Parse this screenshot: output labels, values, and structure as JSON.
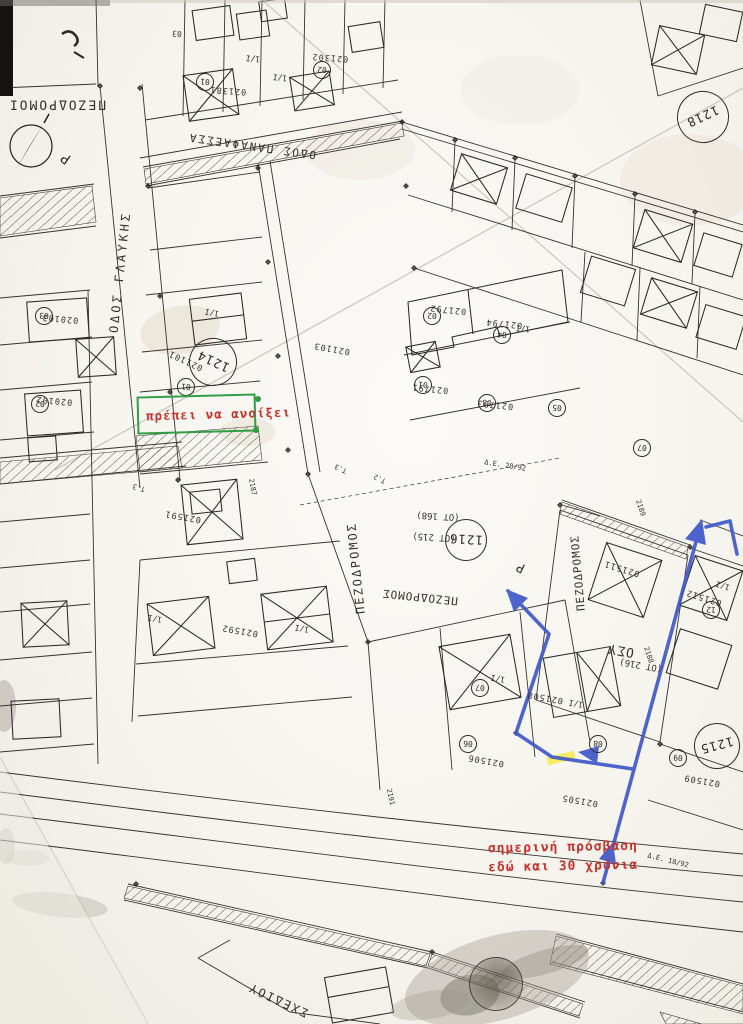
{
  "annotations": {
    "green_note": {
      "text": "πρέπει να ανοίξει"
    },
    "access_note": {
      "line1": "σημερινή πρόσβαση",
      "line2": "εδώ και 30 χρόνια"
    }
  },
  "colors": {
    "annotation_red": "#c8322b",
    "annotation_green": "#2f9e44",
    "annotation_blue": "#3f57c9",
    "highlight_yellow": "#f4ea3e",
    "ink": "#35332f"
  },
  "block_circles": [
    {
      "v": "1214",
      "x": 213,
      "y": 362,
      "rad": 24,
      "r": 205
    },
    {
      "v": "1216",
      "x": 466,
      "y": 540,
      "rad": 21,
      "r": 183
    },
    {
      "v": "1218",
      "x": 703,
      "y": 117,
      "rad": 26,
      "r": 155
    },
    {
      "v": "1215",
      "x": 717,
      "y": 746,
      "rad": 23,
      "r": 165
    },
    {
      "v": "",
      "x": 496,
      "y": 984,
      "rad": 27,
      "r": 160,
      "smudged": true
    }
  ],
  "lot_circles": [
    {
      "v": "01",
      "x": 205,
      "y": 82
    },
    {
      "v": "02",
      "x": 322,
      "y": 70
    },
    {
      "v": "01",
      "x": 186,
      "y": 387
    },
    {
      "v": "03",
      "x": 44,
      "y": 316
    },
    {
      "v": "02",
      "x": 40,
      "y": 404
    },
    {
      "v": "01",
      "x": 423,
      "y": 385
    },
    {
      "v": "02",
      "x": 432,
      "y": 316
    },
    {
      "v": "03",
      "x": 487,
      "y": 403
    },
    {
      "v": "04",
      "x": 502,
      "y": 335
    },
    {
      "v": "05",
      "x": 557,
      "y": 408
    },
    {
      "v": "07",
      "x": 642,
      "y": 448
    },
    {
      "v": "12",
      "x": 711,
      "y": 610
    },
    {
      "v": "08",
      "x": 598,
      "y": 744
    },
    {
      "v": "09",
      "x": 678,
      "y": 758
    },
    {
      "v": "06",
      "x": 468,
      "y": 744
    },
    {
      "v": "07",
      "x": 480,
      "y": 688
    }
  ],
  "map_labels": [
    {
      "t": "ΠΕΖΟΔΡΟΜΟΙ",
      "x": 57,
      "y": 104,
      "r": 180,
      "s": 13,
      "sp": 2,
      "n": "street-label-pezodromoi"
    },
    {
      "t": "Ρ",
      "x": 66,
      "y": 158,
      "r": 215,
      "s": 14,
      "n": "letter-p-mark"
    },
    {
      "t": "ΟΔΟΣ ΓΛΑΥΚΗΣ",
      "x": 120,
      "y": 272,
      "r": -84,
      "s": 12,
      "sp": 3,
      "n": "street-label-odos-glafkis"
    },
    {
      "t": "ΟΔΟΣ ΠΑΝΑΦΑΕΣΣΑ",
      "x": 252,
      "y": 146,
      "r": 188,
      "s": 11,
      "sp": 2,
      "n": "street-label-odos-panafaessa"
    },
    {
      "t": "ΠΕΖΟΔΡΟΜΟΣ",
      "x": 356,
      "y": 568,
      "r": -96,
      "s": 12,
      "sp": 2,
      "n": "street-label-pezodromos-center"
    },
    {
      "t": "ΠΕΖΟΔΡΟΜΟΣ",
      "x": 420,
      "y": 597,
      "r": 186,
      "s": 11,
      "sp": 1,
      "n": "street-label-pezodromos-south"
    },
    {
      "t": "ΠΕΖΟΔΡΟΜΟΣ",
      "x": 578,
      "y": 573,
      "r": -95,
      "s": 11,
      "sp": 1,
      "n": "street-label-pezodromos-east"
    },
    {
      "t": "Ρ",
      "x": 521,
      "y": 567,
      "r": 205,
      "s": 13,
      "n": "letter-p-mark-2"
    },
    {
      "t": "ΣΧΕΔΙΟΥ",
      "x": 278,
      "y": 1000,
      "r": 205,
      "s": 12,
      "sp": 2,
      "n": "label-schediou"
    },
    {
      "t": "ΟΣΥ",
      "x": 621,
      "y": 650,
      "r": 190,
      "s": 13,
      "sp": 1,
      "n": "label-osy"
    },
    {
      "t": "(ΟΤ 216)",
      "x": 641,
      "y": 664,
      "r": 190,
      "s": 9,
      "n": "block-ref-ot216"
    },
    {
      "t": "(ΟΤ 168)",
      "x": 438,
      "y": 515,
      "r": 183,
      "s": 9,
      "n": "block-ref-ot168"
    },
    {
      "t": "(ΟΤ 215)",
      "x": 434,
      "y": 536,
      "r": 183,
      "s": 9,
      "n": "block-ref-ot215"
    },
    {
      "t": "021381",
      "x": 228,
      "y": 90,
      "r": 184,
      "s": 8.5,
      "sp": 1,
      "n": "parcel-number"
    },
    {
      "t": "021302",
      "x": 330,
      "y": 57,
      "r": 184,
      "s": 8.5,
      "sp": 1,
      "n": "parcel-number"
    },
    {
      "t": "021101",
      "x": 186,
      "y": 360,
      "r": 205,
      "s": 8.5,
      "sp": 1,
      "n": "parcel-number"
    },
    {
      "t": "020103",
      "x": 60,
      "y": 318,
      "r": 185,
      "s": 8.5,
      "sp": 1,
      "n": "parcel-number"
    },
    {
      "t": "020102",
      "x": 54,
      "y": 400,
      "r": 185,
      "s": 8.5,
      "sp": 1,
      "n": "parcel-number"
    },
    {
      "t": "021103",
      "x": 332,
      "y": 348,
      "r": 190,
      "s": 8.5,
      "sp": 1,
      "n": "parcel-number"
    },
    {
      "t": "021591",
      "x": 183,
      "y": 516,
      "r": 190,
      "s": 8.5,
      "sp": 1,
      "n": "parcel-number"
    },
    {
      "t": "021592",
      "x": 240,
      "y": 630,
      "r": 190,
      "s": 8.5,
      "sp": 1,
      "n": "parcel-number"
    },
    {
      "t": "021792",
      "x": 448,
      "y": 309,
      "r": 186,
      "s": 8.5,
      "sp": 1,
      "n": "parcel-number"
    },
    {
      "t": "021794",
      "x": 504,
      "y": 323,
      "r": 186,
      "s": 8.5,
      "sp": 1,
      "n": "parcel-number"
    },
    {
      "t": "021791",
      "x": 430,
      "y": 388,
      "r": 186,
      "s": 8.5,
      "sp": 1,
      "n": "parcel-number"
    },
    {
      "t": "021793",
      "x": 495,
      "y": 404,
      "r": 186,
      "s": 8.5,
      "sp": 1,
      "n": "parcel-number"
    },
    {
      "t": "021511",
      "x": 622,
      "y": 568,
      "r": 197,
      "s": 8.5,
      "sp": 1,
      "n": "parcel-number"
    },
    {
      "t": "021512",
      "x": 704,
      "y": 597,
      "r": 197,
      "s": 8.5,
      "sp": 1,
      "n": "parcel-number"
    },
    {
      "t": "021508",
      "x": 545,
      "y": 697,
      "r": 190,
      "s": 8.5,
      "sp": 1,
      "n": "parcel-number"
    },
    {
      "t": "021506",
      "x": 486,
      "y": 760,
      "r": 190,
      "s": 8.5,
      "sp": 1,
      "n": "parcel-number"
    },
    {
      "t": "021505",
      "x": 580,
      "y": 800,
      "r": 190,
      "s": 8.5,
      "sp": 1,
      "n": "parcel-number"
    },
    {
      "t": "021509",
      "x": 702,
      "y": 780,
      "r": 190,
      "s": 8.5,
      "sp": 1,
      "n": "parcel-number"
    },
    {
      "t": "1/Ι",
      "x": 253,
      "y": 58,
      "r": 186,
      "s": 8,
      "n": "floor-label"
    },
    {
      "t": "1/Ι",
      "x": 280,
      "y": 77,
      "r": 186,
      "s": 8,
      "n": "floor-label"
    },
    {
      "t": "1/Ι",
      "x": 212,
      "y": 312,
      "r": 190,
      "s": 8,
      "n": "floor-label"
    },
    {
      "t": "1/Ι",
      "x": 523,
      "y": 328,
      "r": 186,
      "s": 8,
      "n": "floor-label"
    },
    {
      "t": "1/Ι",
      "x": 498,
      "y": 678,
      "r": 190,
      "s": 8,
      "n": "floor-label"
    },
    {
      "t": "1/Ι",
      "x": 155,
      "y": 618,
      "r": 190,
      "s": 8,
      "n": "floor-label"
    },
    {
      "t": "1/Ι",
      "x": 302,
      "y": 628,
      "r": 190,
      "s": 8,
      "n": "floor-label"
    },
    {
      "t": "1/Ι",
      "x": 723,
      "y": 585,
      "r": 197,
      "s": 8,
      "n": "floor-label"
    },
    {
      "t": "1/Ι",
      "x": 576,
      "y": 703,
      "r": 190,
      "s": 8,
      "n": "floor-label"
    },
    {
      "t": "03",
      "x": 177,
      "y": 33,
      "r": 184,
      "s": 8,
      "n": "lot-number-plain"
    },
    {
      "t": "Τ.3",
      "x": 341,
      "y": 468,
      "r": 205,
      "s": 7,
      "n": "survey-tick-label"
    },
    {
      "t": "Τ.2",
      "x": 380,
      "y": 478,
      "r": 205,
      "s": 7,
      "n": "survey-tick-label"
    },
    {
      "t": "Τ.3",
      "x": 139,
      "y": 487,
      "r": 195,
      "s": 7,
      "n": "survey-tick-label"
    },
    {
      "t": "2187",
      "x": 252,
      "y": 487,
      "r": 80,
      "s": 7,
      "n": "elevation-label"
    },
    {
      "t": "2189",
      "x": 640,
      "y": 508,
      "r": 72,
      "s": 7,
      "n": "elevation-label"
    },
    {
      "t": "2188",
      "x": 648,
      "y": 655,
      "r": 72,
      "s": 7,
      "n": "elevation-label"
    },
    {
      "t": "2191",
      "x": 390,
      "y": 797,
      "r": 78,
      "s": 7,
      "n": "elevation-label"
    },
    {
      "t": "Δ.Ε. 28/92",
      "x": 505,
      "y": 466,
      "r": 9,
      "s": 7,
      "n": "survey-note"
    },
    {
      "t": "Δ.Ε. 18/92",
      "x": 668,
      "y": 861,
      "r": 14,
      "s": 7,
      "n": "survey-note"
    }
  ]
}
